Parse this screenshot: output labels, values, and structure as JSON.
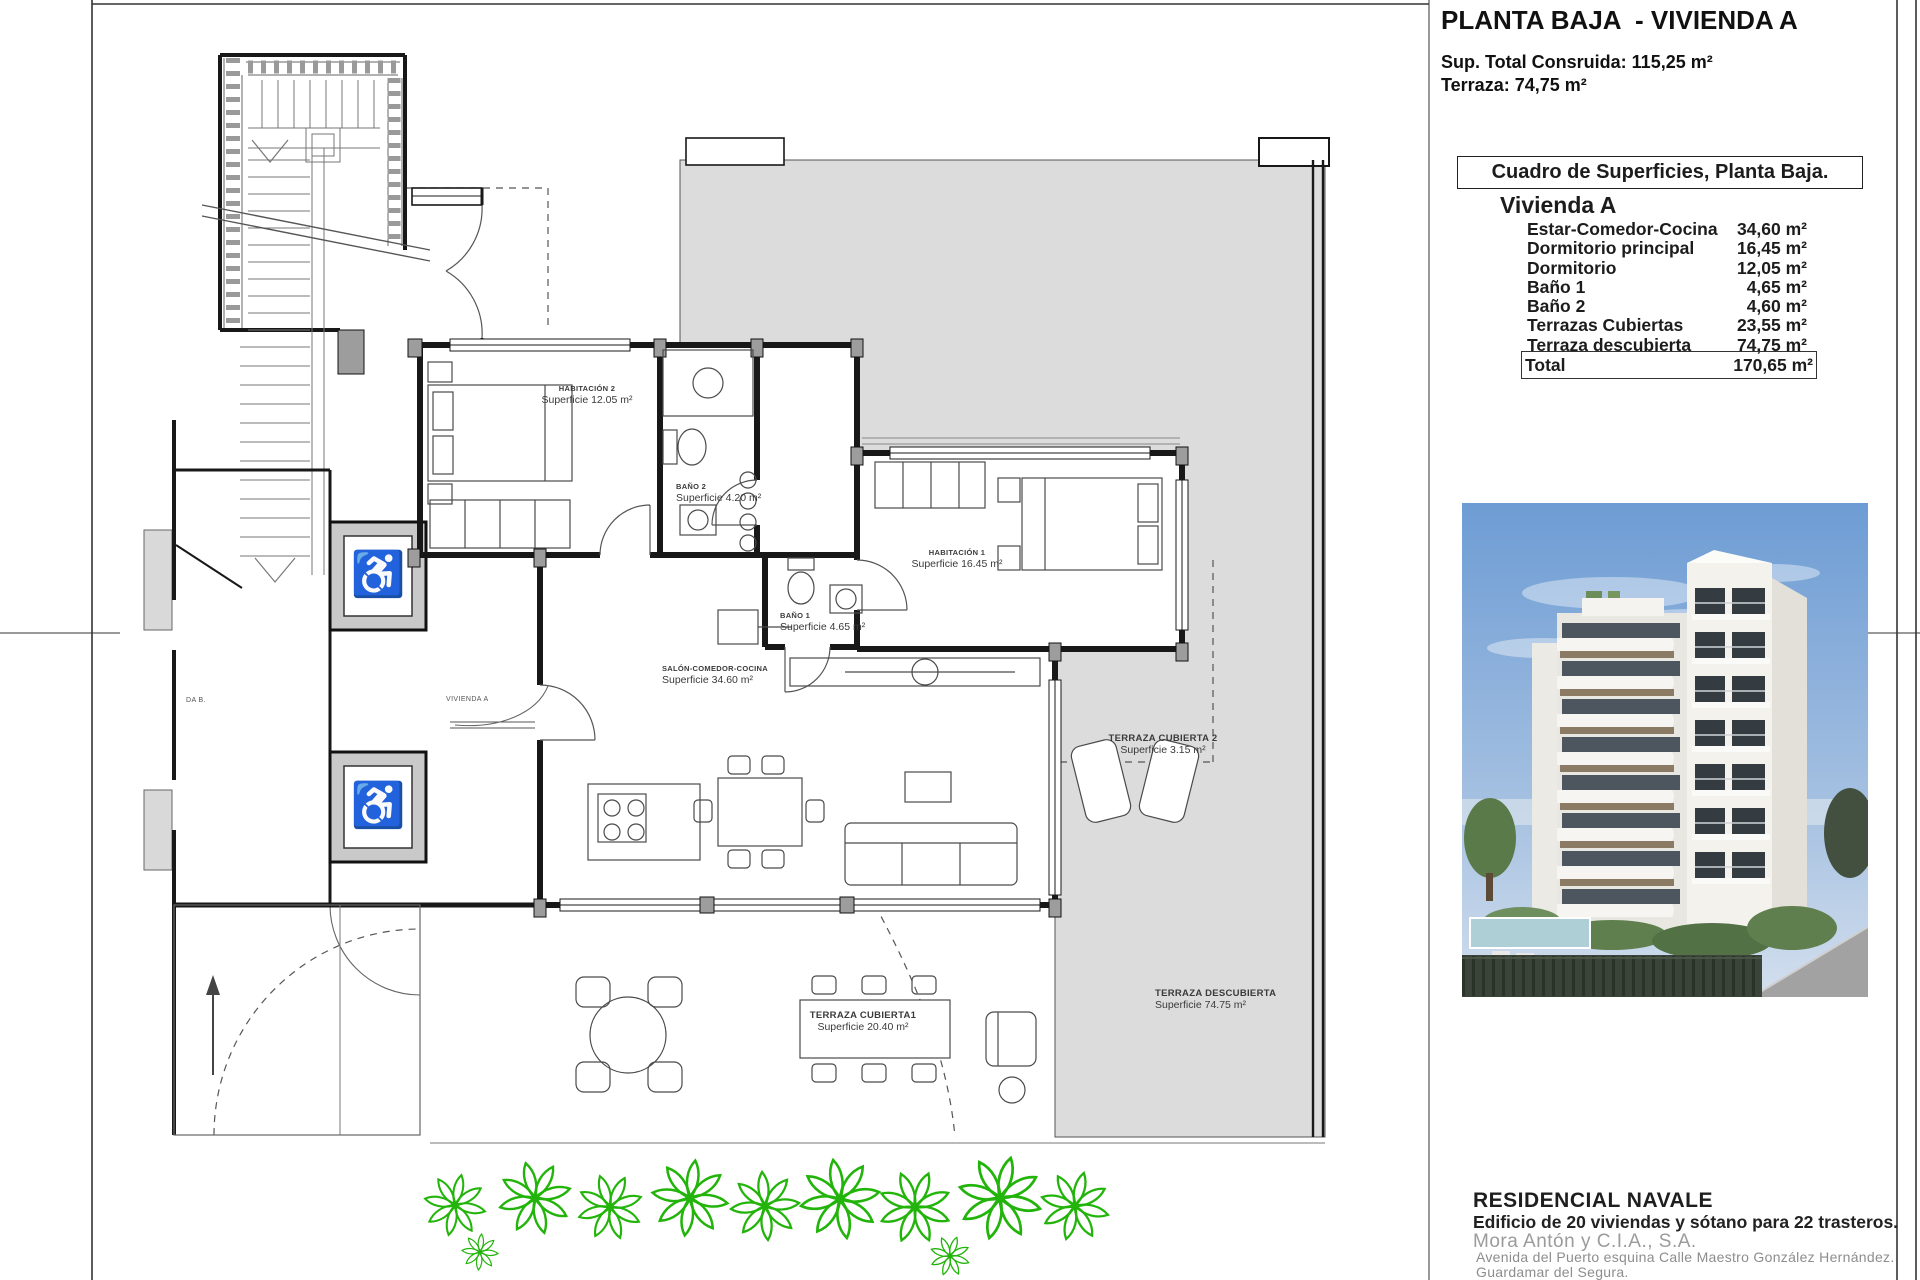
{
  "header": {
    "title": "PLANTA BAJA  - VIVIENDA A",
    "built_line": "Sup. Total Consruida: 115,25 m²",
    "terrace_line": "Terraza: 74,75 m²"
  },
  "surface_table": {
    "box_title": "Cuadro de Superficies, Planta Baja.",
    "dwelling": "Vivienda A",
    "rows": [
      {
        "label": "Estar-Comedor-Cocina",
        "value": "34,60 m²"
      },
      {
        "label": "Dormitorio principal",
        "value": "16,45 m²"
      },
      {
        "label": "Dormitorio",
        "value": "12,05 m²"
      },
      {
        "label": "Baño 1",
        "value": "4,65 m²"
      },
      {
        "label": "Baño 2",
        "value": "4,60 m²"
      },
      {
        "label": "Terrazas Cubiertas",
        "value": "23,55 m²"
      },
      {
        "label": "Terraza descubierta",
        "value": "74,75 m²"
      }
    ],
    "total": {
      "label": "Total",
      "value": "170,65 m²"
    }
  },
  "plan": {
    "rooms": {
      "habitacion2": {
        "name": "HABITACIÓN 2",
        "area": "Superficie 12.05 m²"
      },
      "bano2": {
        "name": "BAÑO 2",
        "area": "Superficie 4.20 m²"
      },
      "habitacion1": {
        "name": "HABITACIÓN 1",
        "area": "Superficie 16.45 m²"
      },
      "bano1": {
        "name": "BAÑO 1",
        "area": "Superficie 4.65 m²"
      },
      "salon": {
        "name": "SALÓN-COMEDOR-COCINA",
        "area": "Superficie 34.60 m²"
      },
      "terraza_cubierta2": {
        "name": "TERRAZA CUBIERTA 2",
        "area": "Superficie 3.15 m²"
      },
      "terraza_cubierta1": {
        "name": "TERRAZA CUBIERTA1",
        "area": "Superficie 20.40 m²"
      },
      "terraza_descubierta": {
        "name": "TERRAZA DESCUBIERTA",
        "area": "Superficie 74.75 m²"
      }
    },
    "tags": {
      "vivienda_a": "VIVIENDA A",
      "vivienda_b_partial": "DA B."
    },
    "icons": {
      "wheelchair": "♿"
    }
  },
  "footer": {
    "project_name": "RESIDENCIAL NAVALE",
    "description": "Edificio de 20 viviendas y sótano para 22 trasteros.",
    "company": "Mora Antón y C.I.A., S.A.",
    "address_line1": "Avenida del Puerto esquina Calle Maestro González Hernández.",
    "address_line2": "Guardamar del Segura.",
    "address_line3_clipped": "Proyecto 2011. Cl. 7G. 1."
  },
  "colors": {
    "terrace_gray": "#dcdcdc",
    "wall_black": "#181818",
    "plant_green": "#23b40b",
    "sky_blue": "#6d9cd4",
    "building_white": "#f3f2ed"
  }
}
